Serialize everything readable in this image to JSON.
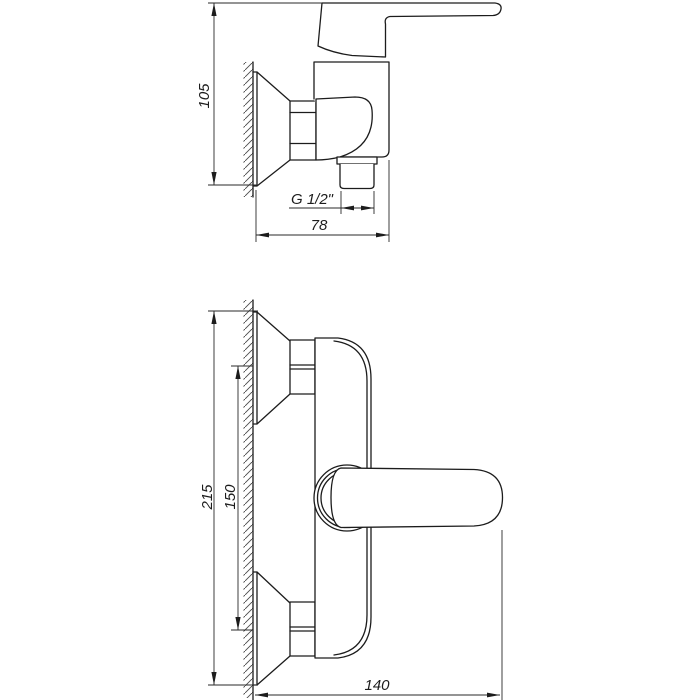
{
  "drawing": {
    "background": "#ffffff",
    "line_color": "#1c1c1c",
    "views": [
      "side",
      "front"
    ]
  },
  "labels": {
    "side_height": "105",
    "side_depth": "78",
    "thread": "G 1/2\"",
    "front_height": "215",
    "front_centers": "150",
    "front_depth": "140"
  }
}
